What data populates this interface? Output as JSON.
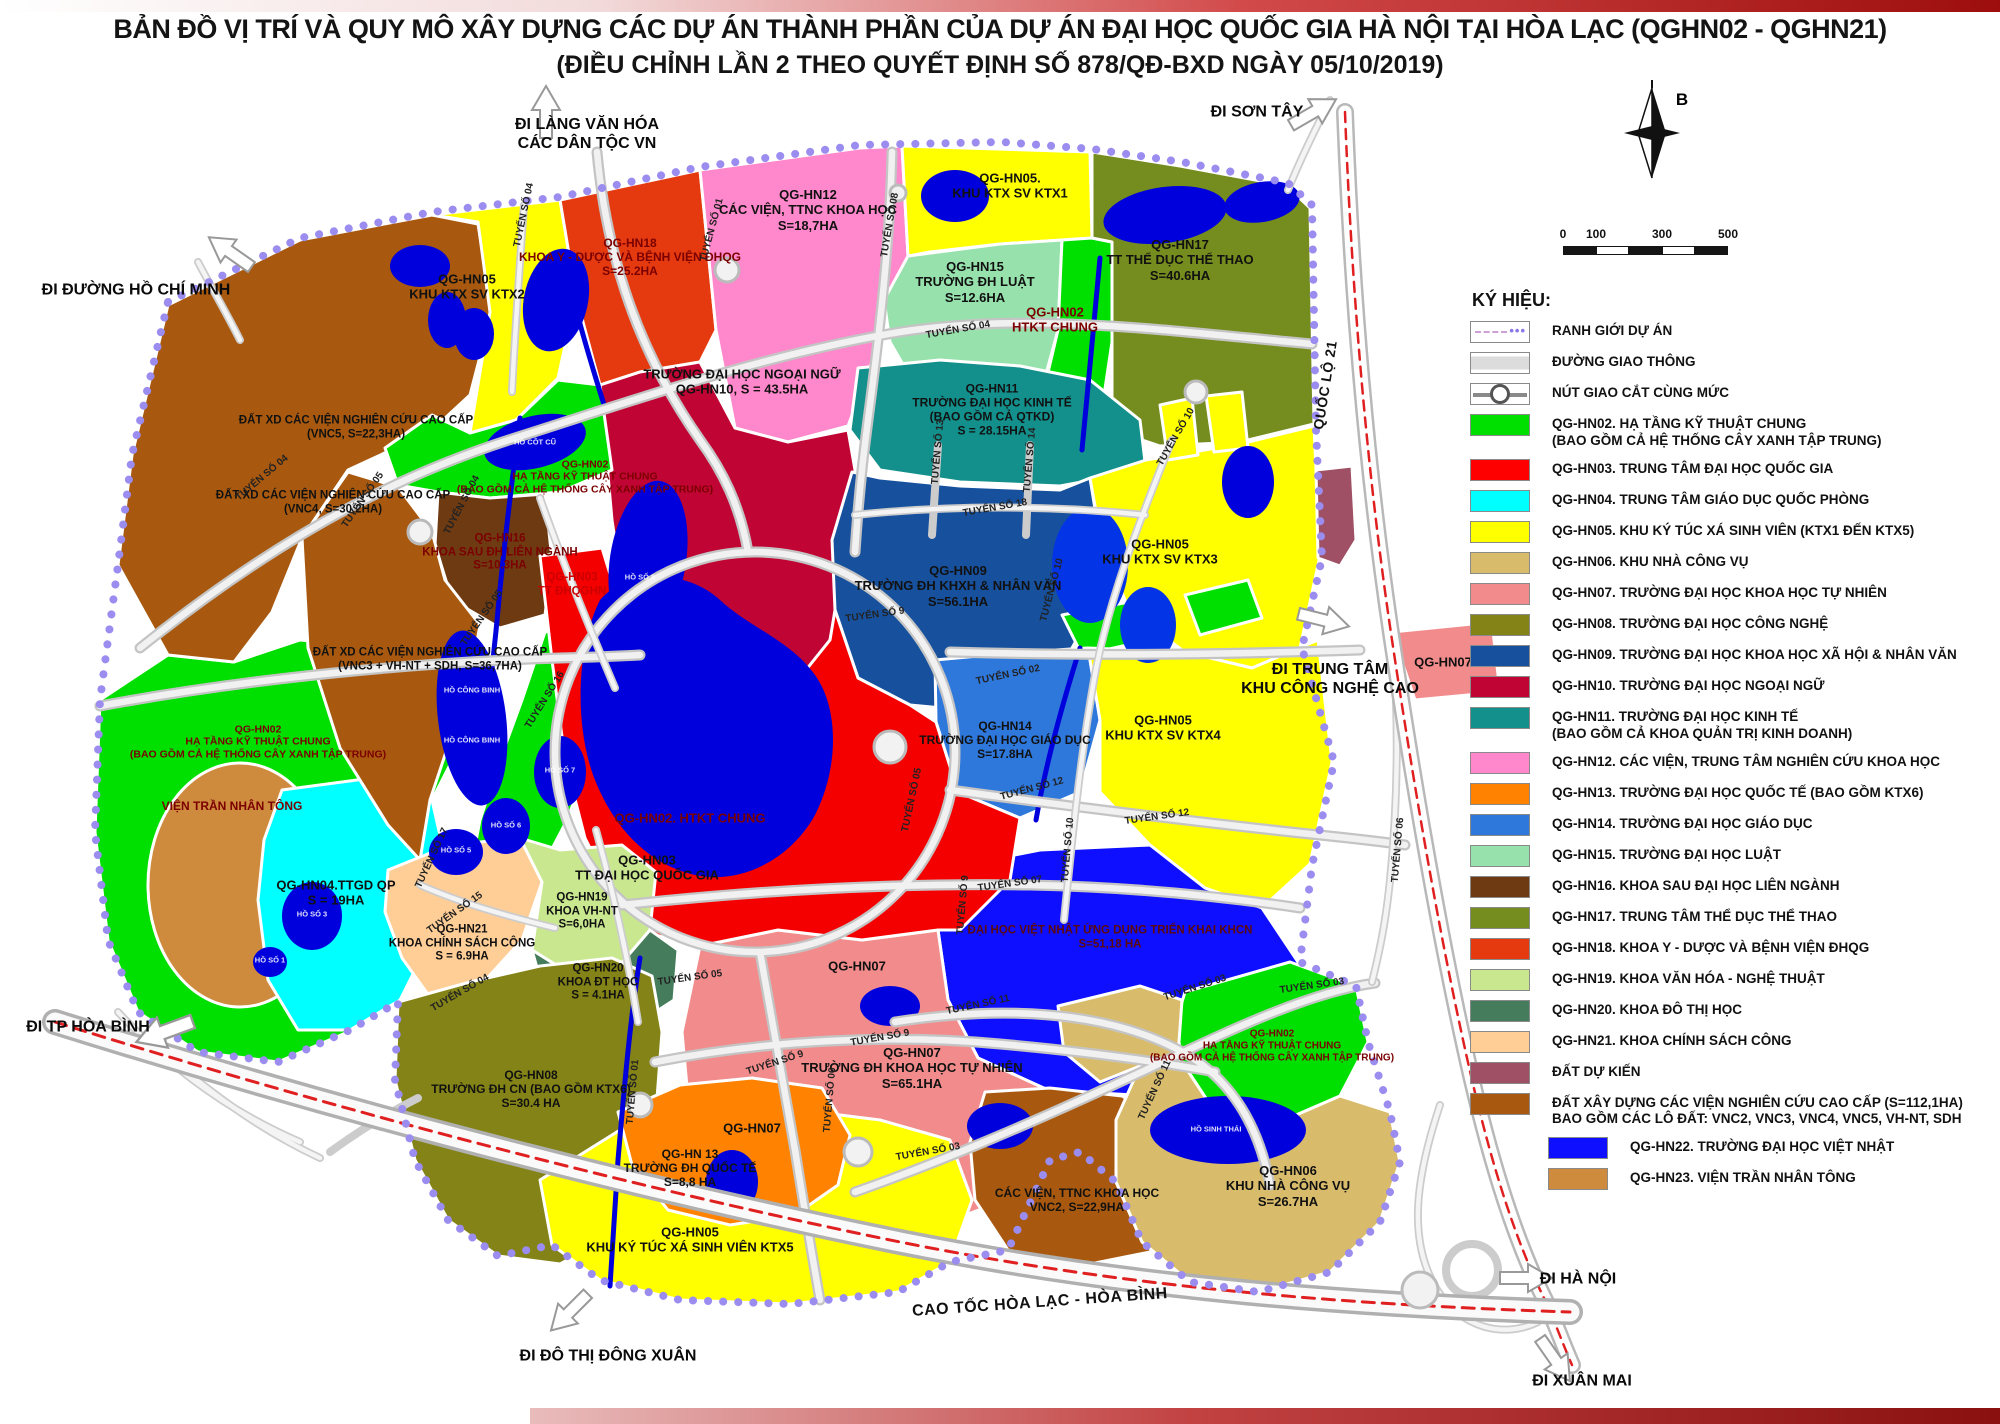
{
  "title": {
    "line1": "BẢN ĐỒ VỊ TRÍ VÀ QUY MÔ XÂY DỰNG CÁC DỰ ÁN THÀNH PHẦN CỦA DỰ ÁN ĐẠI HỌC QUỐC GIA HÀ NỘI TẠI HÒA LẠC (QGHN02 - QGHN21)",
    "line2": "(ĐIỀU CHỈNH LẦN 2 THEO QUYẾT ĐỊNH SỐ 878/QĐ-BXD NGÀY 05/10/2019)"
  },
  "compass": {
    "label": "B"
  },
  "scale": {
    "ticks": [
      {
        "label": "0",
        "x": 8,
        "y": 6
      },
      {
        "label": "100",
        "x": 41,
        "y": 6
      },
      {
        "label": "300",
        "x": 107,
        "y": 6
      },
      {
        "label": "500",
        "x": 173,
        "y": 6
      }
    ]
  },
  "legend": {
    "title": "KÝ HIỆU:",
    "items": [
      {
        "type": "boundary",
        "lines": [
          "RANH GIỚI DỰ ÁN"
        ]
      },
      {
        "type": "road",
        "lines": [
          "ĐƯỜNG GIAO THÔNG"
        ]
      },
      {
        "type": "junction",
        "lines": [
          "NÚT GIAO CẮT CÙNG MỨC"
        ]
      },
      {
        "color": "#00E000",
        "lines": [
          "QG-HN02. HẠ TẦNG KỸ THUẬT CHUNG",
          "(BAO GỒM CẢ HỆ THỐNG CÂY XANH TẬP TRUNG)"
        ]
      },
      {
        "color": "#FF0000",
        "lines": [
          "QG-HN03. TRUNG TÂM ĐẠI HỌC QUỐC GIA"
        ]
      },
      {
        "color": "#00FFFF",
        "lines": [
          "QG-HN04. TRUNG TÂM GIÁO DỤC QUỐC PHÒNG"
        ]
      },
      {
        "color": "#FFFF00",
        "lines": [
          "QG-HN05. KHU KÝ TÚC XÁ SINH VIÊN (KTX1 ĐẾN KTX5)"
        ]
      },
      {
        "color": "#D9BC6B",
        "lines": [
          "QG-HN06. KHU NHÀ CÔNG VỤ"
        ]
      },
      {
        "color": "#F28C8C",
        "lines": [
          "QG-HN07. TRƯỜNG ĐẠI HỌC KHOA HỌC TỰ NHIÊN"
        ]
      },
      {
        "color": "#838317",
        "lines": [
          "QG-HN08. TRƯỜNG ĐẠI HỌC CÔNG NGHỆ"
        ]
      },
      {
        "color": "#17519E",
        "lines": [
          "QG-HN09. TRƯỜNG ĐẠI HỌC KHOA HỌC XÃ HỘI & NHÂN VĂN"
        ]
      },
      {
        "color": "#C00534",
        "lines": [
          "QG-HN10. TRƯỜNG ĐẠI HỌC NGOẠI NGỮ"
        ]
      },
      {
        "color": "#13908C",
        "lines": [
          "QG-HN11. TRƯỜNG ĐẠI HỌC KINH TẾ",
          "(BAO GỒM CẢ KHOA QUẢN TRỊ KINH DOANH)"
        ]
      },
      {
        "color": "#FF87CB",
        "lines": [
          "QG-HN12. CÁC VIỆN, TRUNG TÂM NGHIÊN CỨU KHOA HỌC"
        ]
      },
      {
        "color": "#FF8300",
        "lines": [
          "QG-HN13. TRƯỜNG ĐẠI HỌC QUỐC TẾ (BAO GỒM KTX6)"
        ]
      },
      {
        "color": "#2E78DC",
        "lines": [
          "QG-HN14. TRƯỜNG ĐẠI HỌC GIÁO DỤC"
        ]
      },
      {
        "color": "#97E2AC",
        "lines": [
          "QG-HN15. TRƯỜNG ĐẠI HỌC LUẬT"
        ]
      },
      {
        "color": "#6E3A12",
        "lines": [
          "QG-HN16. KHOA SAU ĐẠI HỌC LIÊN NGÀNH"
        ]
      },
      {
        "color": "#758C1E",
        "lines": [
          "QG-HN17. TRUNG TÂM THỂ DỤC THỂ THAO"
        ]
      },
      {
        "color": "#E53A10",
        "lines": [
          "QG-HN18. KHOA Y - DƯỢC VÀ BỆNH VIỆN ĐHQG"
        ]
      },
      {
        "color": "#C9E78F",
        "lines": [
          "QG-HN19. KHOA VĂN HÓA - NGHỆ THUẬT"
        ]
      },
      {
        "color": "#447C5C",
        "lines": [
          "QG-HN20. KHOA ĐÔ THỊ HỌC"
        ]
      },
      {
        "color": "#FFCE96",
        "lines": [
          "QG-HN21. KHOA CHÍNH SÁCH CÔNG"
        ]
      },
      {
        "color": "#A05064",
        "lines": [
          "ĐẤT DỰ KIẾN"
        ]
      },
      {
        "color": "#A8590F",
        "lines": [
          "ĐẤT XÂY DỰNG CÁC VIỆN NGHIÊN CỨU CAO CẤP (S=112,1HA)",
          "BAO GỒM CÁC LÔ ĐẤT: VNC2, VNC3, VNC4, VNC5, VH-NT, SDH"
        ]
      },
      {
        "color": "#0F0FFF",
        "indent": true,
        "lines": [
          "QG-HN22. TRƯỜNG ĐẠI HỌC VIỆT NHẬT"
        ]
      },
      {
        "color": "#CE8B3E",
        "indent": true,
        "lines": [
          "QG-HN23. VIỆN TRẦN NHÂN TÔNG"
        ]
      }
    ]
  },
  "map": {
    "zone_labels": [
      {
        "lines": [
          "QG-HN05",
          "KHU KTX SV KTX2"
        ],
        "x": 467,
        "y": 287
      },
      {
        "lines": [
          "QG-HN18",
          "KHOA Y - DƯỢC VÀ BỆNH VIỆN ĐHQG",
          "S=25.2HA"
        ],
        "x": 630,
        "y": 257,
        "color": "#7B0000",
        "size": 12
      },
      {
        "lines": [
          "ĐẤT XD CÁC VIỆN NGHIÊN CỨU CAO CẤP",
          "(VNC5, S=22,3HA)"
        ],
        "x": 356,
        "y": 428,
        "size": 11.5
      },
      {
        "lines": [
          "ĐẤT XD CÁC VIỆN NGHIÊN CỨU CAO CẤP",
          "(VNC4, S=30,2HA)"
        ],
        "x": 333,
        "y": 503,
        "size": 11.5
      },
      {
        "lines": [
          "QG-HN12",
          "CÁC VIỆN, TTNC KHOA HỌC",
          "S=18,7HA"
        ],
        "x": 808,
        "y": 210
      },
      {
        "lines": [
          "QG-HN05.",
          "KHU KTX SV KTX1"
        ],
        "x": 1010,
        "y": 186
      },
      {
        "lines": [
          "QG-HN15",
          "TRƯỜNG ĐH LUẬT",
          "S=12.6HA"
        ],
        "x": 975,
        "y": 282
      },
      {
        "lines": [
          "QG-HN02",
          "HTKT CHUNG"
        ],
        "x": 1055,
        "y": 320,
        "color": "#7B0000"
      },
      {
        "lines": [
          "QG-HN17",
          "TT THỂ DỤC THỂ THAO",
          "S=40.6HA"
        ],
        "x": 1180,
        "y": 260
      },
      {
        "lines": [
          "TRƯỜNG ĐẠI HỌC NGOẠI NGỮ",
          "QG-HN10, S = 43.5HA"
        ],
        "x": 742,
        "y": 382
      },
      {
        "lines": [
          "QG-HN11",
          "TRƯỜNG ĐẠI HỌC KINH TẾ",
          "(BAO GỒM CẢ QTKD)",
          "S = 28.15HA"
        ],
        "x": 992,
        "y": 410,
        "size": 12
      },
      {
        "lines": [
          "QG-HN09",
          "TRƯỜNG ĐH KHXH & NHÂN VĂN",
          "S=56.1HA"
        ],
        "x": 958,
        "y": 586
      },
      {
        "lines": [
          "QG-HN05",
          "KHU KTX SV KTX3"
        ],
        "x": 1160,
        "y": 552
      },
      {
        "lines": [
          "QG-HN02",
          "HẠ TẦNG KỸ THUẬT CHUNG",
          "(BAO GỒM CẢ HỆ THỐNG CÂY XANH TẬP TRUNG)"
        ],
        "x": 585,
        "y": 477,
        "color": "#7B0000",
        "size": 10.5
      },
      {
        "lines": [
          "QG-HN16",
          "KHOA SAU ĐH LIÊN NGÀNH",
          "S=10.3HA"
        ],
        "x": 500,
        "y": 553,
        "color": "#7B0000",
        "size": 11.5
      },
      {
        "lines": [
          "QG-HN03",
          "TT ĐHQGHN"
        ],
        "x": 572,
        "y": 585,
        "color": "#CC0000",
        "size": 11.5
      },
      {
        "lines": [
          "ĐẤT XD CÁC VIỆN NGHIÊN CỨU CAO CẤP",
          "(VNC3 + VH-NT + SDH, S=36,7HA)"
        ],
        "x": 430,
        "y": 660,
        "size": 11.5
      },
      {
        "lines": [
          "QG-HN02",
          "HẠ TẦNG KỸ THUẬT CHUNG",
          "(BAO GỒM CẢ HỆ THỐNG CÂY XANH TẬP TRUNG)"
        ],
        "x": 258,
        "y": 742,
        "color": "#7B0000",
        "size": 10.5
      },
      {
        "lines": [
          "VIỆN TRẦN NHÂN TÔNG"
        ],
        "x": 232,
        "y": 806,
        "color": "#7B0000",
        "size": 12
      },
      {
        "lines": [
          "QG-HN04.TTGD QP",
          "S = 19HA"
        ],
        "x": 336,
        "y": 893
      },
      {
        "lines": [
          "QG-HN02. HTKT CHUNG"
        ],
        "x": 690,
        "y": 818,
        "color": "#7B0000"
      },
      {
        "lines": [
          "QG-HN03",
          "TT ĐẠI HỌC QUỐC GIA"
        ],
        "x": 647,
        "y": 868
      },
      {
        "lines": [
          "QG-HN14",
          "TRƯỜNG ĐẠI HỌC GIÁO DỤC",
          "S=17.8HA"
        ],
        "x": 1005,
        "y": 740,
        "size": 12
      },
      {
        "lines": [
          "QG-HN05",
          "KHU KTX SV KTX4"
        ],
        "x": 1163,
        "y": 728
      },
      {
        "lines": [
          "ĐẠI HỌC VIỆT NHẬT ỨNG DỤNG TRIỂN KHAI KHCN",
          "S=51,18 HA"
        ],
        "x": 1110,
        "y": 938,
        "color": "#5C0A0A",
        "size": 11.5
      },
      {
        "lines": [
          "QG-HN07"
        ],
        "x": 857,
        "y": 966
      },
      {
        "lines": [
          "QG-HN07",
          "TRƯỜNG ĐH KHOA HỌC TỰ NHIÊN",
          "S=65.1HA"
        ],
        "x": 912,
        "y": 1068
      },
      {
        "lines": [
          "QG-HN07"
        ],
        "x": 752,
        "y": 1128
      },
      {
        "lines": [
          "QG-HN07"
        ],
        "x": 1443,
        "y": 662
      },
      {
        "lines": [
          "QG-HN21",
          "KHOA CHÍNH SÁCH CÔNG",
          "S = 6.9HA"
        ],
        "x": 462,
        "y": 944,
        "size": 11.5
      },
      {
        "lines": [
          "QG-HN19",
          "KHOA VH-NT",
          "S=6,0HA"
        ],
        "x": 582,
        "y": 912,
        "size": 11.5
      },
      {
        "lines": [
          "QG-HN20",
          "KHOA ĐT HỌC",
          "S = 4.1HA"
        ],
        "x": 598,
        "y": 983,
        "size": 11.5
      },
      {
        "lines": [
          "QG-HN08",
          "TRƯỜNG ĐH CN (BAO GỒM KTX6)",
          "S=30.4 HA"
        ],
        "x": 531,
        "y": 1089,
        "size": 12
      },
      {
        "lines": [
          "QG-HN 13",
          "TRƯỜNG ĐH QUỐC TẾ",
          "S=8,8 HA"
        ],
        "x": 690,
        "y": 1168,
        "size": 12
      },
      {
        "lines": [
          "QG-HN05",
          "KHU KÝ TÚC XÁ SINH VIÊN KTX5"
        ],
        "x": 690,
        "y": 1240
      },
      {
        "lines": [
          "CÁC VIỆN, TTNC KHOA HỌC",
          "VNC2, S=22,9HA"
        ],
        "x": 1077,
        "y": 1200,
        "size": 12
      },
      {
        "lines": [
          "QG-HN06",
          "KHU NHÀ CÔNG VỤ",
          "S=26.7HA"
        ],
        "x": 1288,
        "y": 1186
      },
      {
        "lines": [
          "QG-HN02",
          "HẠ TẦNG KỸ THUẬT CHUNG",
          "(BAO GỒM CẢ HỆ THỐNG CÂY XANH TẬP TRUNG)"
        ],
        "x": 1272,
        "y": 1046,
        "color": "#7B0000",
        "size": 10
      }
    ],
    "road_labels": [
      {
        "text": "TUYẾN SỐ 01",
        "x": 712,
        "y": 230,
        "rot": -75
      },
      {
        "text": "TUYẾN SỐ 04",
        "x": 524,
        "y": 215,
        "rot": -78
      },
      {
        "text": "TUYẾN SỐ 08",
        "x": 890,
        "y": 225,
        "rot": -80
      },
      {
        "text": "TUYẾN SỐ 04",
        "x": 958,
        "y": 330,
        "rot": -10
      },
      {
        "text": "TUYẾN SỐ 04",
        "x": 262,
        "y": 478,
        "rot": -40
      },
      {
        "text": "TUYẾN SỐ 05",
        "x": 363,
        "y": 500,
        "rot": -55
      },
      {
        "text": "TUYẾN SỐ 04",
        "x": 462,
        "y": 505,
        "rot": -62
      },
      {
        "text": "TUYẾN SỐ 05",
        "x": 482,
        "y": 618,
        "rot": -55
      },
      {
        "text": "TUYẾN SỐ 16",
        "x": 545,
        "y": 700,
        "rot": -58
      },
      {
        "text": "TUYẾN SỐ 17",
        "x": 432,
        "y": 858,
        "rot": -65
      },
      {
        "text": "TUYẾN SỐ 18",
        "x": 995,
        "y": 508,
        "rot": -10
      },
      {
        "text": "TUYẾN SỐ 13",
        "x": 938,
        "y": 452,
        "rot": -85
      },
      {
        "text": "TUYẾN SỐ 14",
        "x": 1030,
        "y": 460,
        "rot": -85
      },
      {
        "text": "TUYẾN SỐ 9",
        "x": 875,
        "y": 615,
        "rot": -8
      },
      {
        "text": "TUYẾN SỐ 10",
        "x": 1052,
        "y": 590,
        "rot": -75
      },
      {
        "text": "TUYẾN SỐ 10",
        "x": 1176,
        "y": 437,
        "rot": -60
      },
      {
        "text": "TUYẾN SỐ 10",
        "x": 1068,
        "y": 850,
        "rot": -85
      },
      {
        "text": "TUYẾN SỐ 02",
        "x": 1008,
        "y": 675,
        "rot": -12
      },
      {
        "text": "TUYẾN SỐ 12",
        "x": 1032,
        "y": 789,
        "rot": -15
      },
      {
        "text": "TUYẾN SỐ 12",
        "x": 1157,
        "y": 817,
        "rot": -8
      },
      {
        "text": "TUYẾN SỐ 05",
        "x": 912,
        "y": 800,
        "rot": -78
      },
      {
        "text": "TUYẾN SỐ 05",
        "x": 690,
        "y": 978,
        "rot": -8
      },
      {
        "text": "TUYẾN SỐ 01",
        "x": 633,
        "y": 1092,
        "rot": -85
      },
      {
        "text": "TUYẾN SỐ 15",
        "x": 455,
        "y": 913,
        "rot": -35
      },
      {
        "text": "TUYẾN SỐ 04",
        "x": 460,
        "y": 993,
        "rot": -30
      },
      {
        "text": "TUYẾN SỐ 07",
        "x": 1010,
        "y": 884,
        "rot": -8
      },
      {
        "text": "TUYẾN SỐ 9",
        "x": 963,
        "y": 905,
        "rot": -85
      },
      {
        "text": "TUYẾN SỐ 9",
        "x": 880,
        "y": 1038,
        "rot": -10
      },
      {
        "text": "TUYẾN SỐ 9",
        "x": 775,
        "y": 1063,
        "rot": -18
      },
      {
        "text": "TUYẾN SỐ 11",
        "x": 978,
        "y": 1005,
        "rot": -12
      },
      {
        "text": "TUYẾN SỐ 11",
        "x": 1155,
        "y": 1090,
        "rot": -65
      },
      {
        "text": "TUYẾN SỐ 03",
        "x": 1195,
        "y": 988,
        "rot": -18
      },
      {
        "text": "TUYẾN SỐ 03",
        "x": 1312,
        "y": 986,
        "rot": -8
      },
      {
        "text": "TUYẾN SỐ 03",
        "x": 928,
        "y": 1152,
        "rot": -10
      },
      {
        "text": "TUYẾN SỐ 06",
        "x": 1398,
        "y": 850,
        "rot": -85
      },
      {
        "text": "TUYẾN SỐ 06",
        "x": 830,
        "y": 1100,
        "rot": -85
      }
    ],
    "lake_labels": [
      {
        "text": "HỒ CÔT CŨ",
        "x": 535,
        "y": 442
      },
      {
        "text": "HỒ SỐ 8",
        "x": 640,
        "y": 577
      },
      {
        "text": "HỒ CÔNG BINH",
        "x": 472,
        "y": 690
      },
      {
        "text": "HỒ CÔNG BINH",
        "x": 472,
        "y": 740
      },
      {
        "text": "HỒ SỐ 7",
        "x": 560,
        "y": 770
      },
      {
        "text": "HỒ SỐ 6",
        "x": 506,
        "y": 825
      },
      {
        "text": "HỒ SỐ 5",
        "x": 456,
        "y": 850
      },
      {
        "text": "HỒ SỐ 3",
        "x": 312,
        "y": 914
      },
      {
        "text": "HỒ SỐ 1",
        "x": 270,
        "y": 960
      },
      {
        "text": "HỒ SINH THÁI",
        "x": 1216,
        "y": 1129
      }
    ],
    "direction_labels": [
      {
        "lines": [
          "ĐI LÀNG VĂN HÓA",
          "CÁC DÂN TỘC VN"
        ],
        "x": 587,
        "y": 134
      },
      {
        "lines": [
          "ĐI SƠN TÂY"
        ],
        "x": 1257,
        "y": 112
      },
      {
        "lines": [
          "ĐI ĐƯỜNG HỒ CHÍ MINH"
        ],
        "x": 136,
        "y": 290
      },
      {
        "lines": [
          "ĐI TRUNG TÂM",
          "KHU CÔNG NGHỆ CAO"
        ],
        "x": 1330,
        "y": 679
      },
      {
        "lines": [
          "ĐI TP HÒA BÌNH"
        ],
        "x": 88,
        "y": 1027
      },
      {
        "lines": [
          "ĐI HÀ NỘI"
        ],
        "x": 1578,
        "y": 1279
      },
      {
        "lines": [
          "ĐI XUÂN MAI"
        ],
        "x": 1582,
        "y": 1381
      },
      {
        "lines": [
          "ĐI ĐÔ THỊ ĐÔNG XUÂN"
        ],
        "x": 608,
        "y": 1356
      }
    ],
    "highway_labels": [
      {
        "text": "CAO TỐC HÒA LẠC - HÒA BÌNH",
        "x": 1040,
        "y": 1303,
        "rot": -4,
        "size": 16
      },
      {
        "text": "QUỐC LỘ 21",
        "x": 1325,
        "y": 385,
        "rot": -81,
        "size": 14
      }
    ]
  }
}
